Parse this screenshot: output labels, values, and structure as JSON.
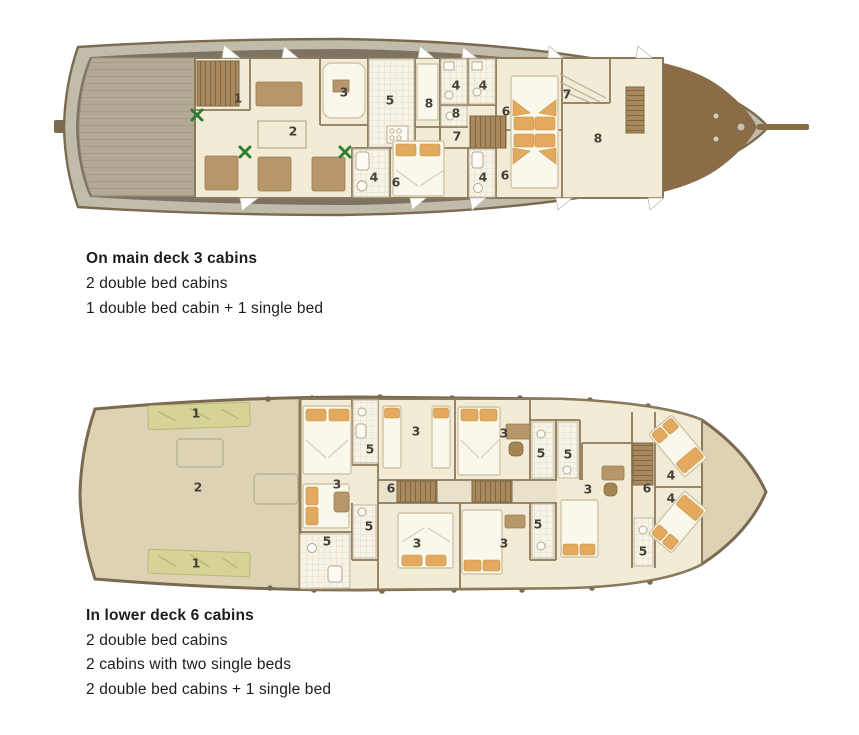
{
  "colors": {
    "hull_outline": "#7a6a50",
    "hull_rim": "#c1bbaa",
    "side_deck": "#7d7365",
    "stern_planks": "#b2aa95",
    "cabin": "#f2ebd6",
    "wall": "#8c7b5a",
    "bow": "#8a6c47",
    "furn": "#b7976a",
    "bed": "#faf7ec",
    "pillow": "#e3aa5f",
    "plant": "#2e7d32",
    "lower_hull": "#ddd3b4",
    "mat": "#d5d395",
    "stairs": "#a8885c",
    "tile": "#f7f3e7",
    "label": "#44403a",
    "text": "#1d1d1b"
  },
  "main_deck": {
    "heading": "On main deck 3 cabins",
    "lines": [
      "2 double bed cabins",
      "1 double bed cabin + 1 single bed"
    ],
    "labels": [
      {
        "t": "1",
        "x": 238,
        "y": 98
      },
      {
        "t": "2",
        "x": 293,
        "y": 131
      },
      {
        "t": "3",
        "x": 344,
        "y": 92
      },
      {
        "t": "5",
        "x": 390,
        "y": 100
      },
      {
        "t": "8",
        "x": 429,
        "y": 103
      },
      {
        "t": "4",
        "x": 456,
        "y": 85
      },
      {
        "t": "4",
        "x": 483,
        "y": 85
      },
      {
        "t": "8",
        "x": 456,
        "y": 113
      },
      {
        "t": "7",
        "x": 457,
        "y": 136
      },
      {
        "t": "6",
        "x": 506,
        "y": 111
      },
      {
        "t": "7",
        "x": 567,
        "y": 94
      },
      {
        "t": "8",
        "x": 598,
        "y": 138
      },
      {
        "t": "4",
        "x": 374,
        "y": 177
      },
      {
        "t": "6",
        "x": 396,
        "y": 182
      },
      {
        "t": "4",
        "x": 483,
        "y": 177
      },
      {
        "t": "6",
        "x": 505,
        "y": 175
      }
    ]
  },
  "lower_deck": {
    "heading": "In lower deck 6 cabins",
    "lines": [
      "2 double bed cabins",
      "2 cabins with two single beds",
      "2 double bed cabins + 1 single bed"
    ],
    "labels": [
      {
        "t": "1",
        "x": 196,
        "y": 413
      },
      {
        "t": "2",
        "x": 198,
        "y": 487
      },
      {
        "t": "1",
        "x": 196,
        "y": 563
      },
      {
        "t": "3",
        "x": 416,
        "y": 431
      },
      {
        "t": "3",
        "x": 504,
        "y": 433
      },
      {
        "t": "5",
        "x": 370,
        "y": 449
      },
      {
        "t": "5",
        "x": 541,
        "y": 453
      },
      {
        "t": "5",
        "x": 568,
        "y": 454
      },
      {
        "t": "3",
        "x": 337,
        "y": 484
      },
      {
        "t": "6",
        "x": 391,
        "y": 488
      },
      {
        "t": "3",
        "x": 588,
        "y": 489
      },
      {
        "t": "6",
        "x": 647,
        "y": 488
      },
      {
        "t": "4",
        "x": 671,
        "y": 475
      },
      {
        "t": "4",
        "x": 671,
        "y": 498
      },
      {
        "t": "5",
        "x": 327,
        "y": 541
      },
      {
        "t": "5",
        "x": 369,
        "y": 526
      },
      {
        "t": "5",
        "x": 538,
        "y": 524
      },
      {
        "t": "3",
        "x": 417,
        "y": 543
      },
      {
        "t": "3",
        "x": 504,
        "y": 543
      },
      {
        "t": "5",
        "x": 643,
        "y": 551
      }
    ]
  }
}
